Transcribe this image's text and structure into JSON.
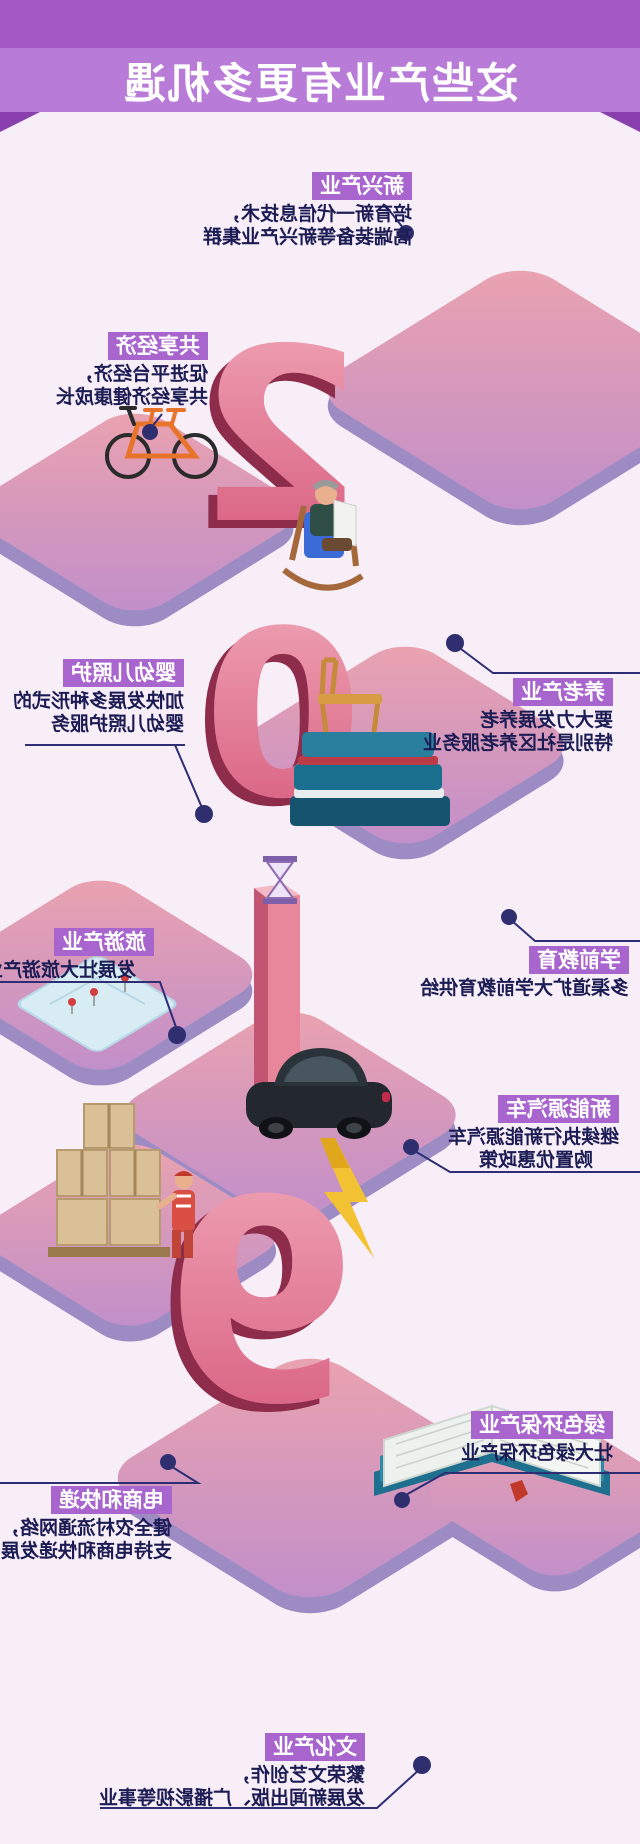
{
  "title": "这些产业有更多机遇",
  "digits": [
    "2",
    "0",
    "1",
    "9"
  ],
  "blocks": [
    {
      "id": "xinxing",
      "label": "新兴产业",
      "lines": [
        "培育新一代信息技术，",
        "高端装备等新兴产业集群"
      ]
    },
    {
      "id": "gongxiang",
      "label": "共享经济",
      "lines": [
        "促进平台经济，",
        "共享经济健康成长"
      ]
    },
    {
      "id": "yanglao",
      "label": "养老产业",
      "lines": [
        "要大力发展养老",
        "特别是社区养老服务业"
      ]
    },
    {
      "id": "yingyouer",
      "label": "婴幼儿照护",
      "lines": [
        "加快发展多种形式的",
        "婴幼儿照护服务"
      ]
    },
    {
      "id": "lvyou",
      "label": "旅游产业",
      "lines": [
        "发展壮大旅游产业"
      ]
    },
    {
      "id": "xueqian",
      "label": "学前教育",
      "lines": [
        "多渠道扩大学前教育供给"
      ]
    },
    {
      "id": "xinnengyuan",
      "label": "新能源汽车",
      "lines": [
        "继续执行新能源汽车",
        "购置优惠政策"
      ]
    },
    {
      "id": "lvse",
      "label": "绿色环保产业",
      "lines": [
        "壮大绿色环保产业"
      ]
    },
    {
      "id": "dianshang",
      "label": "电商和快递",
      "lines": [
        "健全农村流通网络，",
        "支持电商和快递发展"
      ]
    },
    {
      "id": "wenhua",
      "label": "文化产业",
      "lines": [
        "繁荣文艺创作，",
        "发展新闻出版、广播影视等事业"
      ]
    }
  ],
  "colors": {
    "background": "#f8eef7",
    "header_top": "#a158c4",
    "header_band": "#b97bd8",
    "header_fold": "#8a3fae",
    "label_bg": "#a865ce",
    "label_text": "#ffffff",
    "body_text": "#1c1c55",
    "connector": "#2e2e74",
    "plate_light": "#eba3ae",
    "plate_dark": "#c08ecb",
    "plate_edge": "#9d8cc4",
    "digit_light": "#f0a7b8",
    "digit_dark": "#d6587b",
    "digit_shadow": "#8e2c4b",
    "bolt": "#f2c232",
    "car": "#23282e",
    "book_teal": "#2a8aa8",
    "worker_red": "#d94f43"
  }
}
